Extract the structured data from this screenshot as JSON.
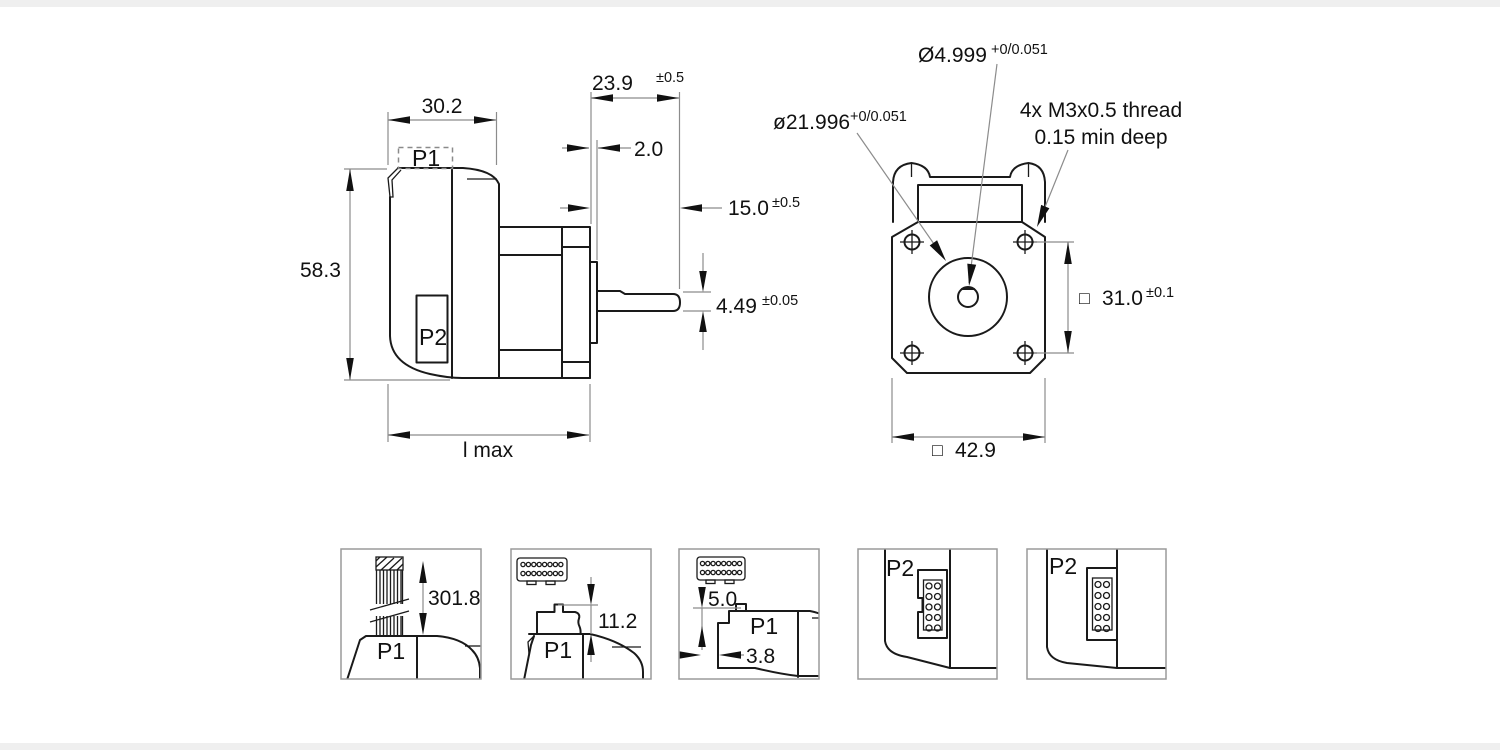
{
  "title": "Stepper motor dimensional drawing",
  "colors": {
    "line": "#1a1a1a",
    "dim_line": "#8c8c8c",
    "text": "#111111",
    "box_border": "#9a9a9a"
  },
  "side_view": {
    "p1": "P1",
    "p2": "P2",
    "width": "30.2",
    "shaft_ext": "23.9",
    "shaft_ext_tol": "±0.5",
    "boss_height": "2.0",
    "flat_length": "15.0",
    "flat_length_tol": "±0.5",
    "height": "58.3",
    "across_flat": "4.49",
    "across_flat_tol": "±0.05",
    "length_label": "l max"
  },
  "front_view": {
    "shaft_dia": "Ø4.999",
    "shaft_dia_tol": "+0/0.051",
    "pilot_dia": "ø21.996",
    "pilot_dia_tol": "+0/0.051",
    "thread_note_1": "4x M3x0.5 thread",
    "thread_note_2": "0.15 min deep",
    "square": "□",
    "hole_spacing": "31.0",
    "hole_spacing_tol": "±0.1",
    "flange_size": "42.9"
  },
  "details": {
    "cable_length": "301.8",
    "p1_a": "P1",
    "p1_height": "11.2",
    "p1_b": "P1",
    "p1_stickout": "5.0",
    "p1_offset": "3.8",
    "p1_c": "P1",
    "p2_a": "P2",
    "p2_b": "P2"
  }
}
